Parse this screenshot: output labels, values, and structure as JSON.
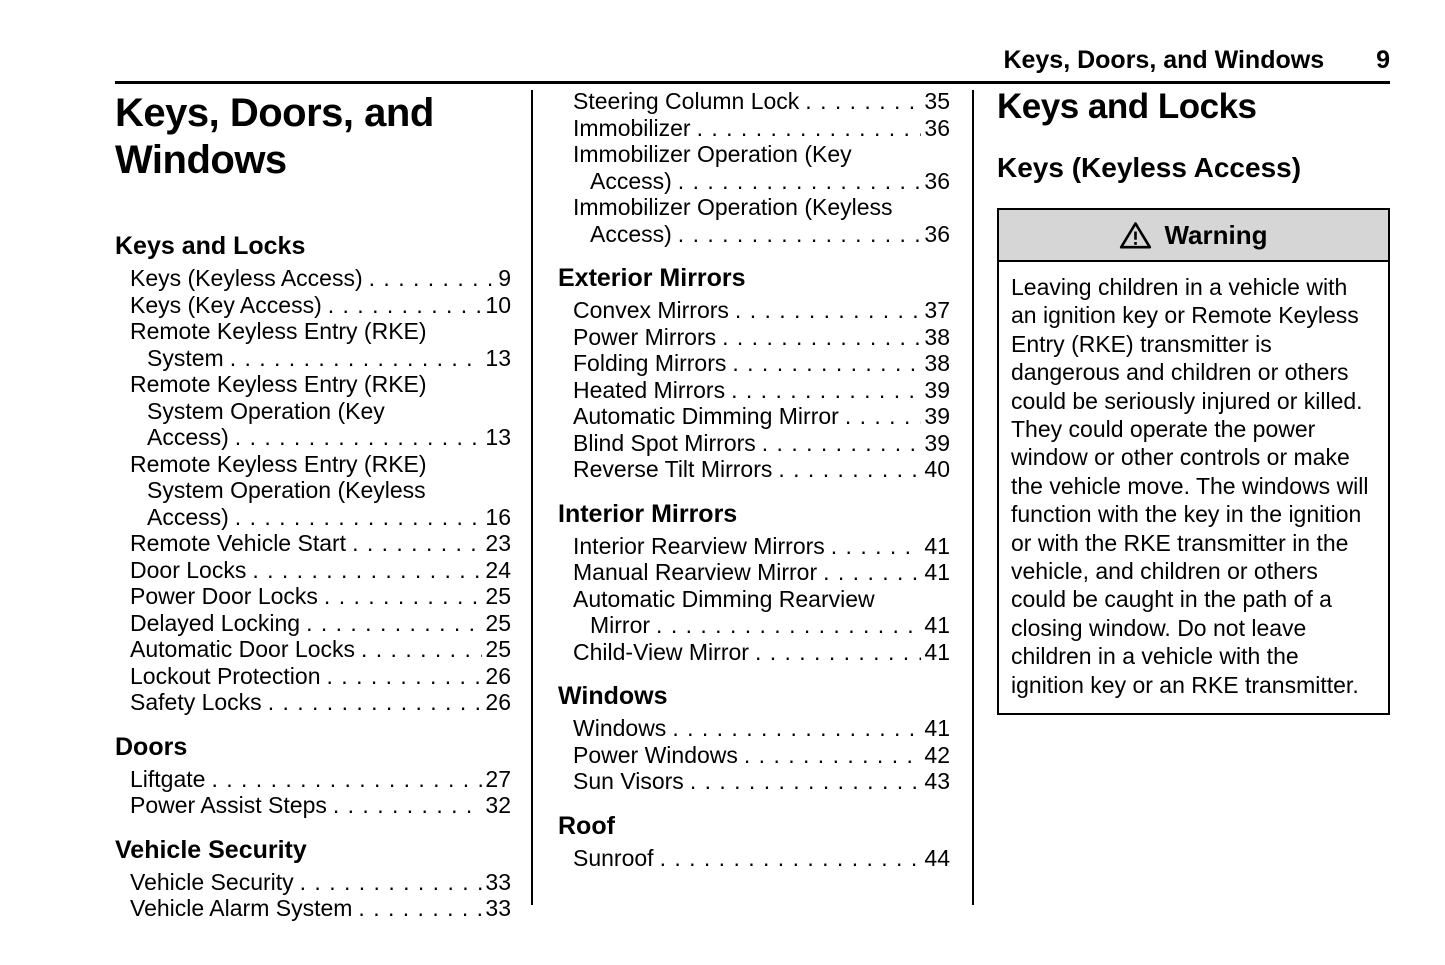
{
  "header": {
    "title": "Keys, Doors, and Windows",
    "page_number": "9"
  },
  "toc": {
    "title": "Keys, Doors, and Windows",
    "columns": [
      {
        "sections": [
          {
            "heading": "Keys and Locks",
            "entries": [
              {
                "lines": [
                  "Keys (Keyless Access)"
                ],
                "page": "9"
              },
              {
                "lines": [
                  "Keys (Key Access)"
                ],
                "page": "10"
              },
              {
                "lines": [
                  "Remote Keyless Entry (RKE)",
                  "System"
                ],
                "page": "13"
              },
              {
                "lines": [
                  "Remote Keyless Entry (RKE)",
                  "System Operation (Key",
                  "Access)"
                ],
                "page": "13"
              },
              {
                "lines": [
                  "Remote Keyless Entry (RKE)",
                  "System Operation (Keyless",
                  "Access)"
                ],
                "page": "16"
              },
              {
                "lines": [
                  "Remote Vehicle Start"
                ],
                "page": "23"
              },
              {
                "lines": [
                  "Door Locks"
                ],
                "page": "24"
              },
              {
                "lines": [
                  "Power Door Locks"
                ],
                "page": "25"
              },
              {
                "lines": [
                  "Delayed Locking"
                ],
                "page": "25"
              },
              {
                "lines": [
                  "Automatic Door Locks"
                ],
                "page": "25"
              },
              {
                "lines": [
                  "Lockout Protection"
                ],
                "page": "26"
              },
              {
                "lines": [
                  "Safety Locks"
                ],
                "page": "26"
              }
            ]
          },
          {
            "heading": "Doors",
            "entries": [
              {
                "lines": [
                  "Liftgate"
                ],
                "page": "27"
              },
              {
                "lines": [
                  "Power Assist Steps"
                ],
                "page": "32"
              }
            ]
          },
          {
            "heading": "Vehicle Security",
            "entries": [
              {
                "lines": [
                  "Vehicle Security"
                ],
                "page": "33"
              },
              {
                "lines": [
                  "Vehicle Alarm System"
                ],
                "page": "33"
              }
            ]
          }
        ]
      },
      {
        "sections": [
          {
            "heading": "",
            "entries": [
              {
                "lines": [
                  "Steering Column Lock"
                ],
                "page": "35"
              },
              {
                "lines": [
                  "Immobilizer"
                ],
                "page": "36"
              },
              {
                "lines": [
                  "Immobilizer Operation (Key",
                  "Access)"
                ],
                "page": "36"
              },
              {
                "lines": [
                  "Immobilizer Operation (Keyless",
                  "Access)"
                ],
                "page": "36"
              }
            ]
          },
          {
            "heading": "Exterior Mirrors",
            "entries": [
              {
                "lines": [
                  "Convex Mirrors"
                ],
                "page": "37"
              },
              {
                "lines": [
                  "Power Mirrors"
                ],
                "page": "38"
              },
              {
                "lines": [
                  "Folding Mirrors"
                ],
                "page": "38"
              },
              {
                "lines": [
                  "Heated Mirrors"
                ],
                "page": "39"
              },
              {
                "lines": [
                  "Automatic Dimming Mirror"
                ],
                "page": "39"
              },
              {
                "lines": [
                  "Blind Spot Mirrors"
                ],
                "page": "39"
              },
              {
                "lines": [
                  "Reverse Tilt Mirrors"
                ],
                "page": "40"
              }
            ]
          },
          {
            "heading": "Interior Mirrors",
            "entries": [
              {
                "lines": [
                  "Interior Rearview Mirrors"
                ],
                "page": "41"
              },
              {
                "lines": [
                  "Manual Rearview Mirror"
                ],
                "page": "41"
              },
              {
                "lines": [
                  "Automatic Dimming Rearview",
                  "Mirror"
                ],
                "page": "41"
              },
              {
                "lines": [
                  "Child-View Mirror"
                ],
                "page": "41"
              }
            ]
          },
          {
            "heading": "Windows",
            "entries": [
              {
                "lines": [
                  "Windows"
                ],
                "page": "41"
              },
              {
                "lines": [
                  "Power Windows"
                ],
                "page": "42"
              },
              {
                "lines": [
                  "Sun Visors"
                ],
                "page": "43"
              }
            ]
          },
          {
            "heading": "Roof",
            "entries": [
              {
                "lines": [
                  "Sunroof"
                ],
                "page": "44"
              }
            ]
          }
        ]
      }
    ]
  },
  "content": {
    "section_heading": "Keys and Locks",
    "subsection_heading": "Keys (Keyless Access)",
    "warning": {
      "label": "Warning",
      "icon": "warning-triangle-icon",
      "body": "Leaving children in a vehicle with an ignition key or Remote Keyless Entry (RKE) transmitter is dangerous and children or others could be seriously injured or killed. They could operate the power window or other controls or make the vehicle move. The windows will function with the key in the ignition or with the RKE transmitter in the vehicle, and children or others could be caught in the path of a closing window. Do not leave children in a vehicle with the ignition key or an RKE transmitter."
    }
  },
  "colors": {
    "text": "#000000",
    "warning_header_bg": "#d6d6d6",
    "divider": "#000000"
  }
}
